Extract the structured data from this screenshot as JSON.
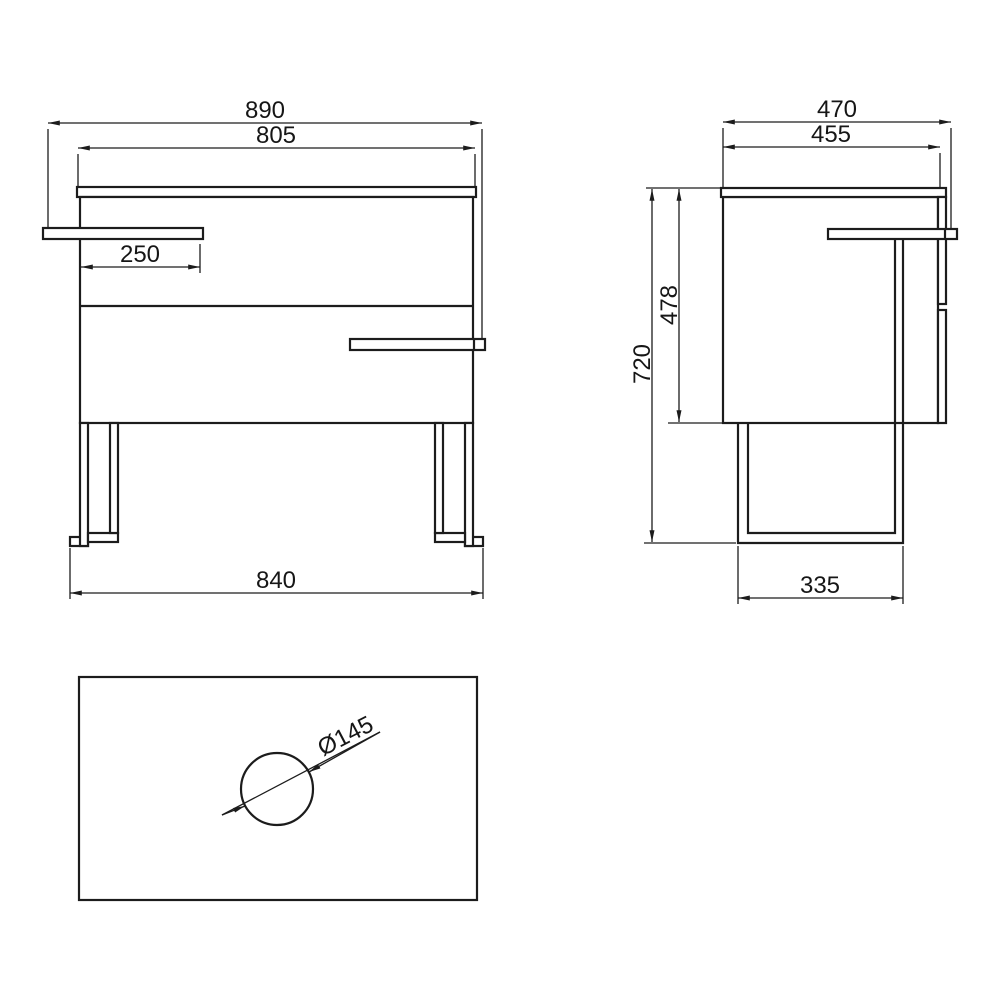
{
  "colors": {
    "line": "#1c1c1c",
    "background": "#ffffff",
    "text": "#161616"
  },
  "views": {
    "front": {
      "dims": {
        "overall_width": "890",
        "cabinet_width": "805",
        "handle_length": "250",
        "feet_span": "840"
      }
    },
    "side": {
      "dims": {
        "overall_depth": "470",
        "cabinet_depth": "455",
        "cabinet_height": "478",
        "overall_height": "720",
        "leg_depth": "335"
      }
    },
    "top": {
      "dims": {
        "hole_diameter": "Ø145"
      }
    }
  }
}
